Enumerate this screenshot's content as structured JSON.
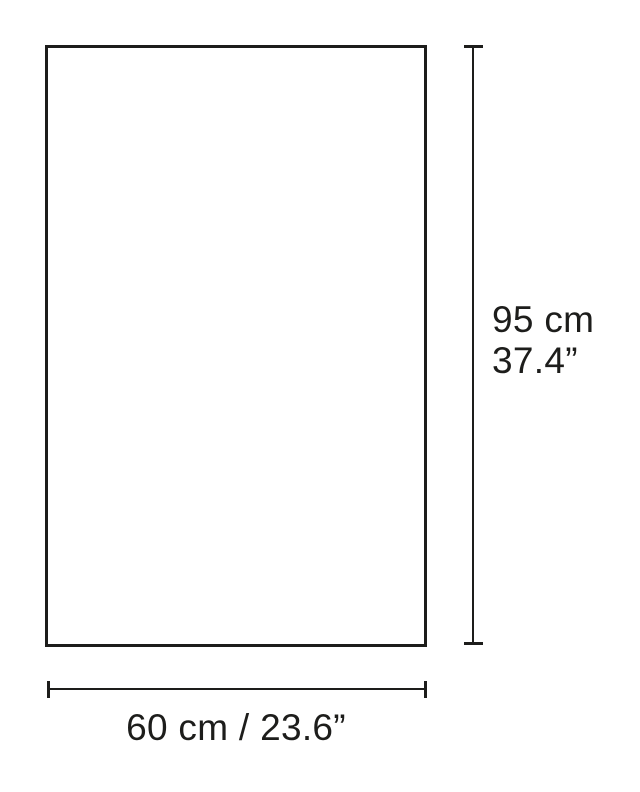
{
  "diagram": {
    "type": "product-dimension-drawing",
    "height_label": {
      "cm": "95 cm",
      "inches": "37.4”"
    },
    "width_label": "60 cm / 23.6”",
    "dimensions": {
      "height_cm": 95,
      "height_in": 37.4,
      "width_cm": 60,
      "width_in": 23.6
    },
    "colors": {
      "line": "#1d1d1b",
      "background": "#ffffff"
    }
  }
}
